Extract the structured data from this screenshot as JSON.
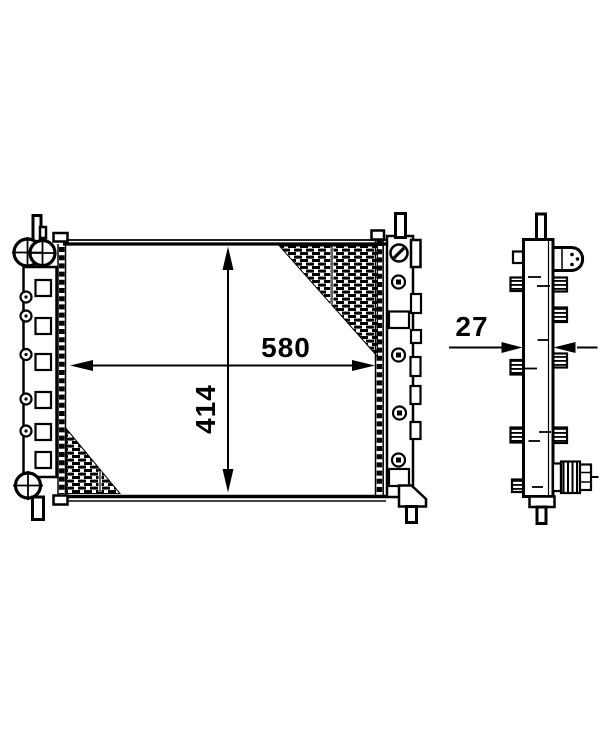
{
  "page": {
    "background_color": "#ffffff",
    "ink_color": "#000000"
  },
  "drawing": {
    "subject": "radiator",
    "views": {
      "front": "front-view",
      "side": "side-view"
    },
    "dimensions": {
      "width": "580",
      "height": "414",
      "depth": "27"
    }
  }
}
